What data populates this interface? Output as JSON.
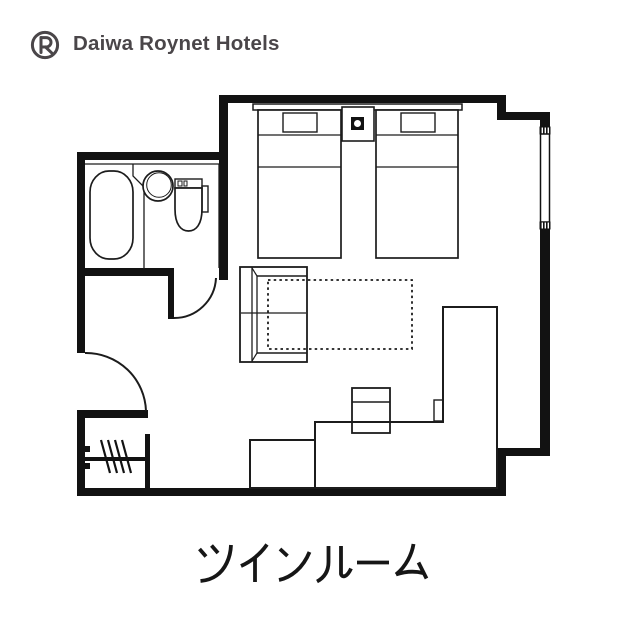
{
  "brand": {
    "name": "Daiwa Roynet Hotels",
    "logo_color": "#4a4649"
  },
  "room": {
    "type_label": "ツインルーム"
  },
  "colors": {
    "background": "#ffffff",
    "wall": "#121212",
    "line": "#1c1c1c",
    "text": "#161616"
  },
  "floorplan": {
    "items": [
      "twin-bed-left",
      "twin-bed-right",
      "headboard",
      "nightstand-with-lamp",
      "bathtub",
      "washbasin",
      "toilet",
      "sofa",
      "sofa-bed-extension-dotted",
      "low-table-area",
      "desk-counter",
      "desk-chair",
      "luggage-bench",
      "closet-hanger-rail",
      "entrance-door",
      "bathroom-door",
      "window"
    ]
  }
}
